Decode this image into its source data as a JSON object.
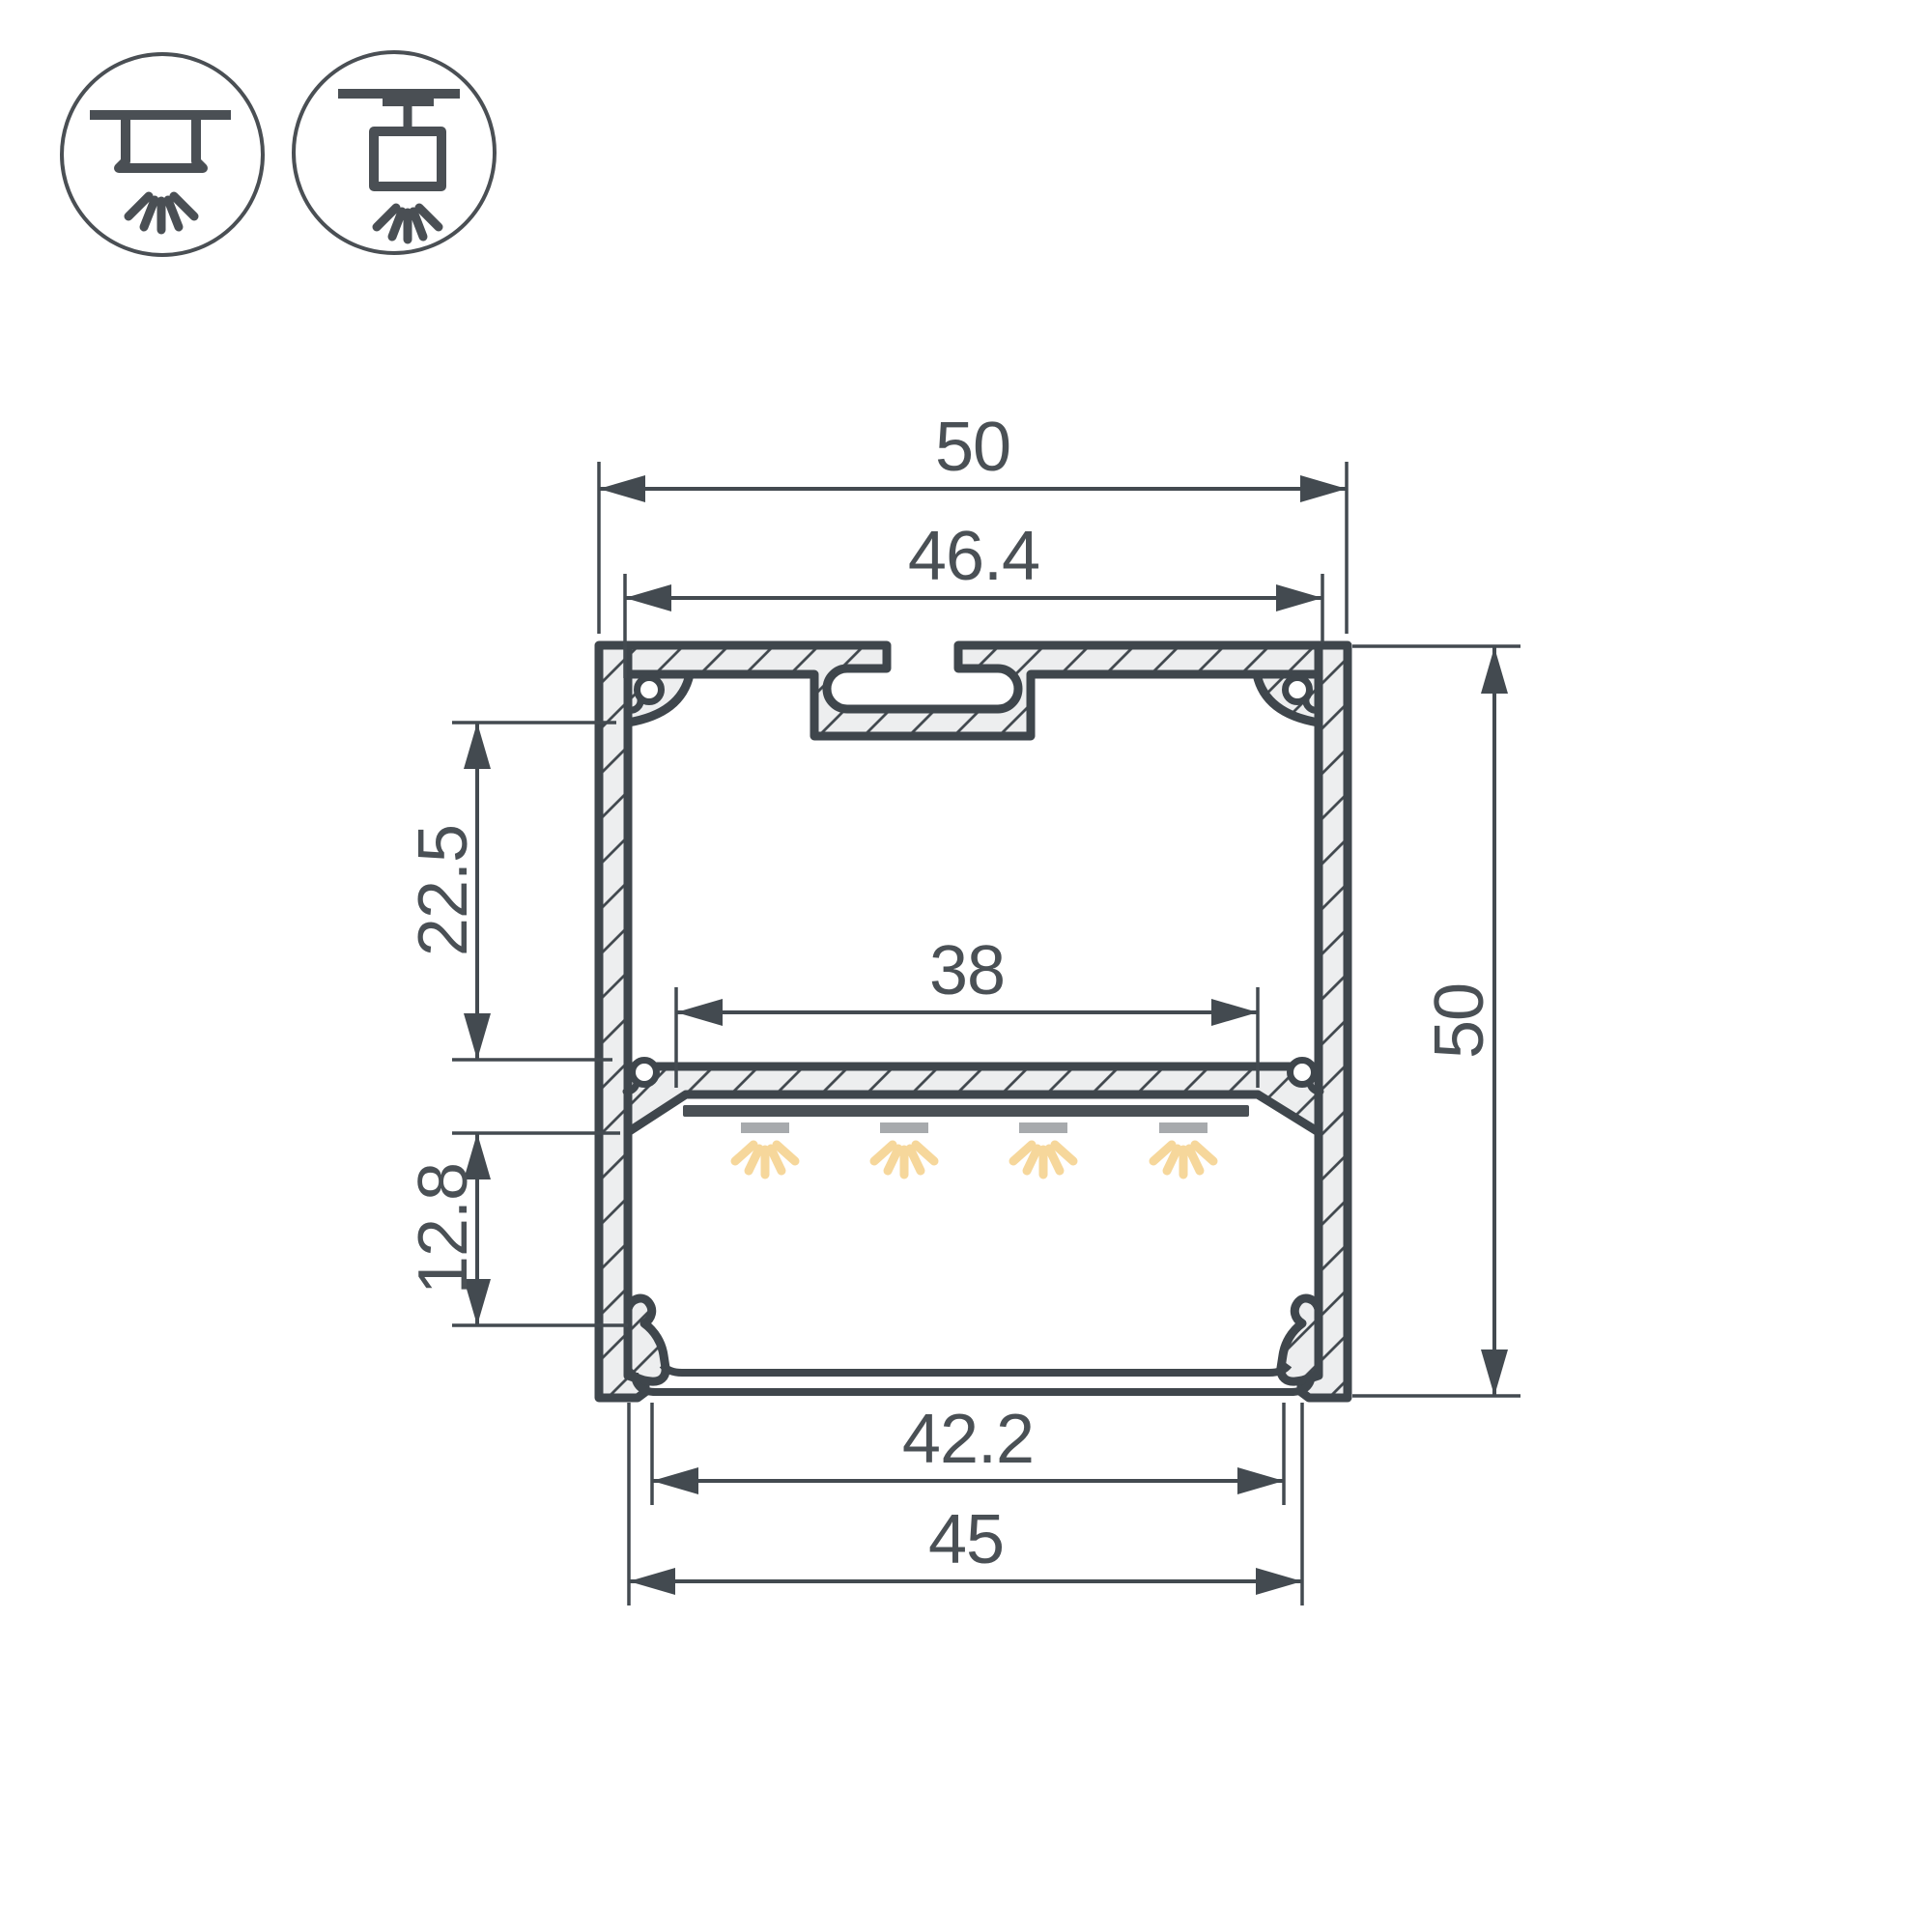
{
  "drawing": {
    "type": "profile-cross-section",
    "background": "#ffffff"
  },
  "colors": {
    "line": "#3F464C",
    "dimension": "#434A50",
    "text": "#4A5055",
    "aluminum_fill": "#EDEEEF",
    "led_bar": "#4A5055",
    "led_module": "#A7AAAD",
    "light_ray": "#F6D79B"
  },
  "mount_icons": [
    {
      "name": "surface-mount"
    },
    {
      "name": "suspended-mount"
    }
  ],
  "dimensions": {
    "overall_width": {
      "label": "50"
    },
    "inner_top_width": {
      "label": "46.4"
    },
    "led_shelf_width": {
      "label": "38"
    },
    "upper_section_height": {
      "label": "22.5"
    },
    "lower_section_height": {
      "label": "12.8"
    },
    "overall_height": {
      "label": "50"
    },
    "diffuser_width": {
      "label": "42.2"
    },
    "bottom_width": {
      "label": "45"
    }
  }
}
